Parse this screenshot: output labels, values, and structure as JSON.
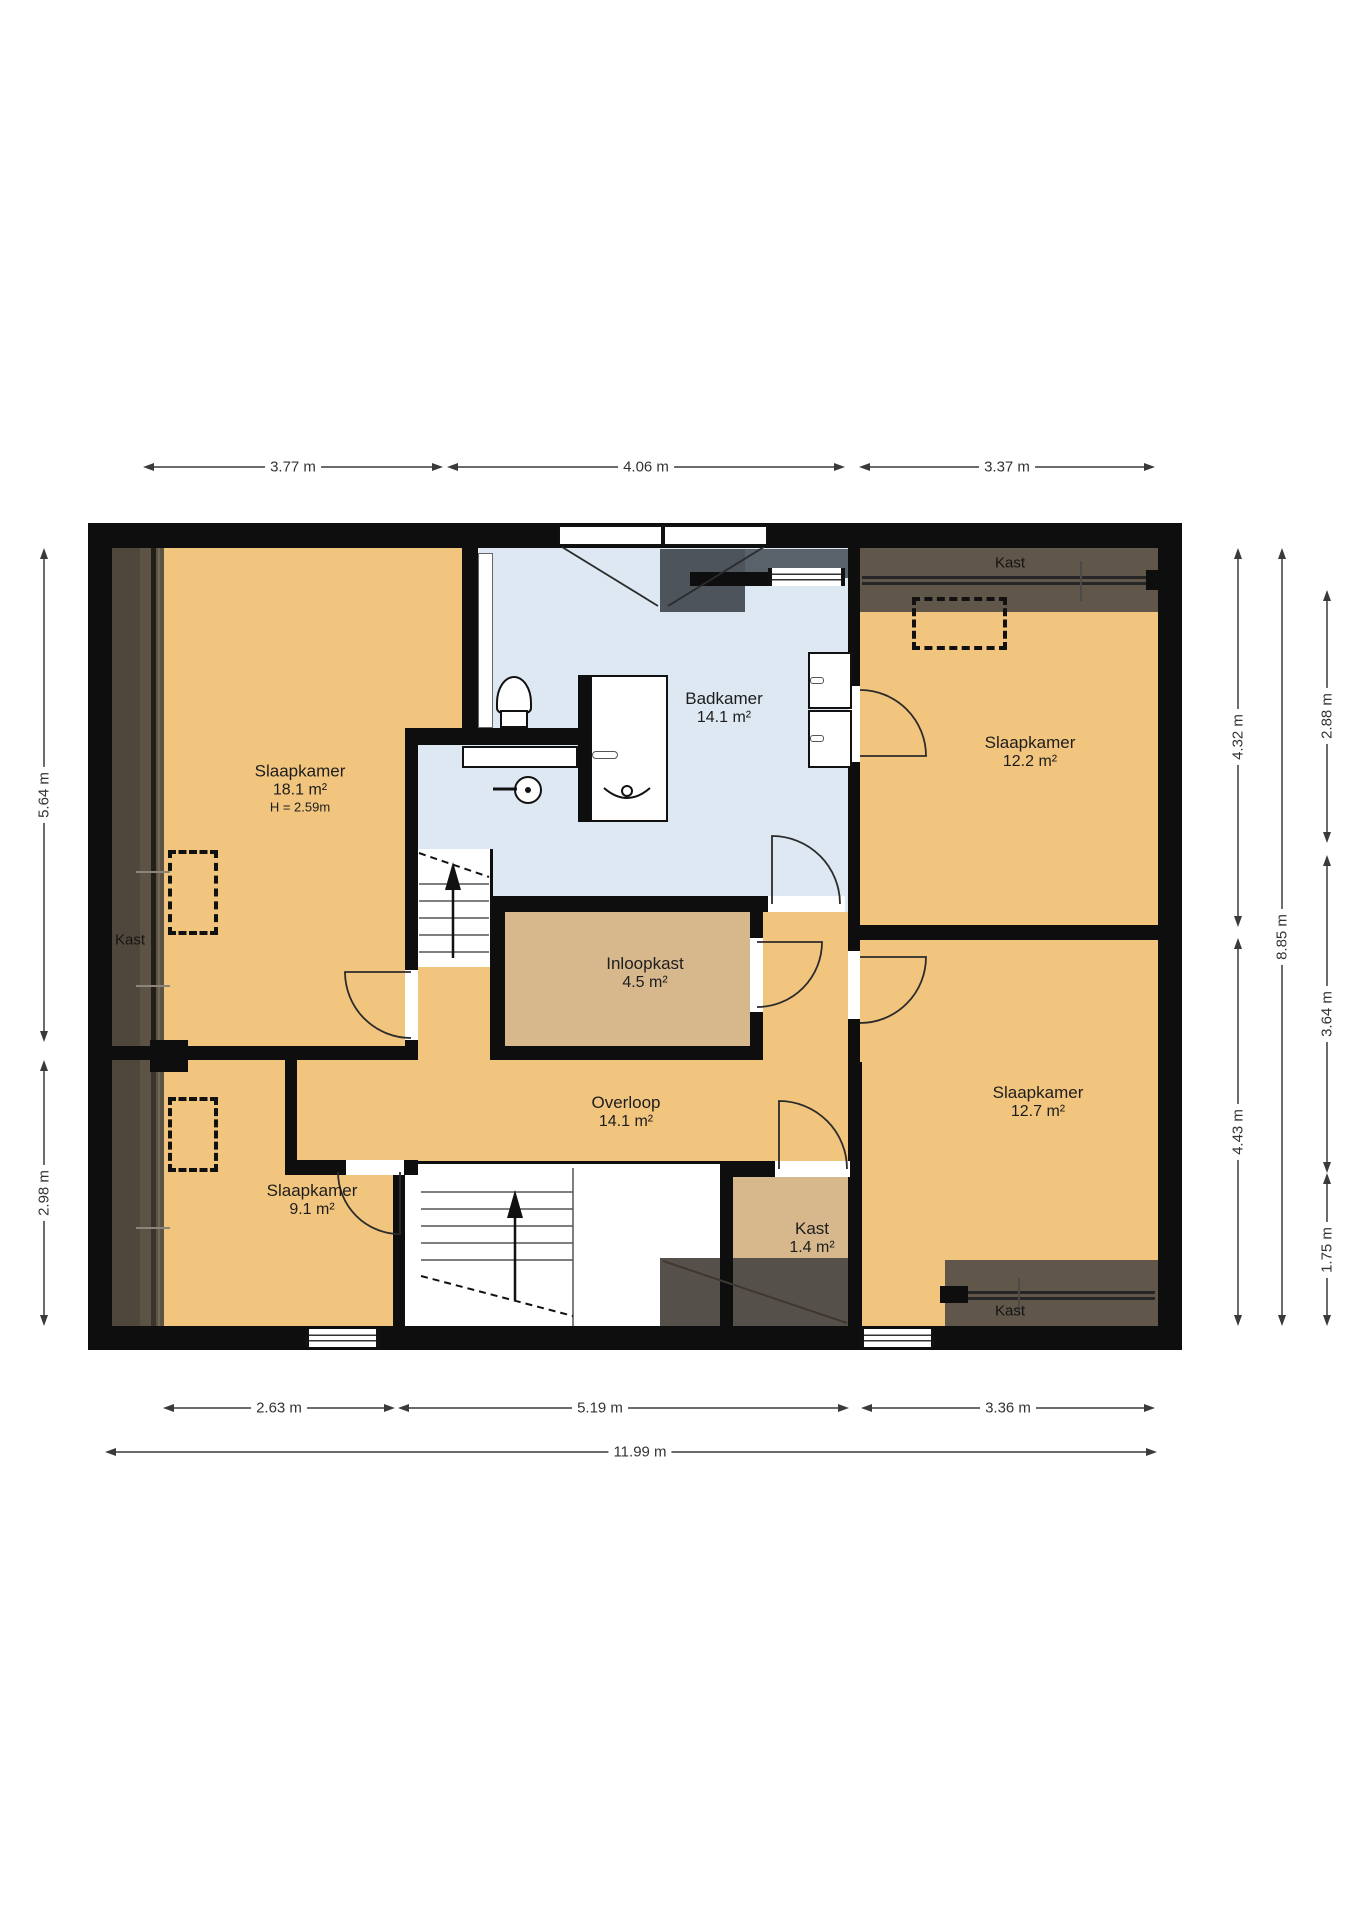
{
  "plan_title": "Eerste verdieping plattegrond",
  "colors": {
    "floor_orange": "#f2c57f",
    "floor_tan": "#d7b88d",
    "floor_blue": "#dde8f2",
    "strip_dark": "#5c5345",
    "dormer_gray": "#4d545b",
    "wall": "#0e0e0e"
  },
  "rooms": [
    {
      "name": "Slaapkamer",
      "area": "18.1 m²",
      "height": "H = 2.59m"
    },
    {
      "name": "Badkamer",
      "area": "14.1 m²"
    },
    {
      "name": "Slaapkamer",
      "area": "12.2 m²"
    },
    {
      "name": "Inloopkast",
      "area": "4.5 m²"
    },
    {
      "name": "Overloop",
      "area": "14.1 m²"
    },
    {
      "name": "Slaapkamer",
      "area": "12.7 m²"
    },
    {
      "name": "Kast",
      "area": "1.4 m²"
    },
    {
      "name": "Slaapkamer",
      "area": "9.1 m²"
    }
  ],
  "closets": {
    "left": "Kast",
    "top_right": "Kast",
    "bottom_right": "Kast"
  },
  "dims": {
    "top": [
      "3.77 m",
      "4.06 m",
      "3.37 m"
    ],
    "bottom": [
      "2.63 m",
      "5.19 m",
      "3.36 m"
    ],
    "total_width": "11.99 m",
    "left": [
      "5.64 m",
      "2.98 m"
    ],
    "right": [
      "4.32 m",
      "4.43 m",
      "8.85 m",
      "2.88 m",
      "3.64 m",
      "1.75 m"
    ]
  }
}
